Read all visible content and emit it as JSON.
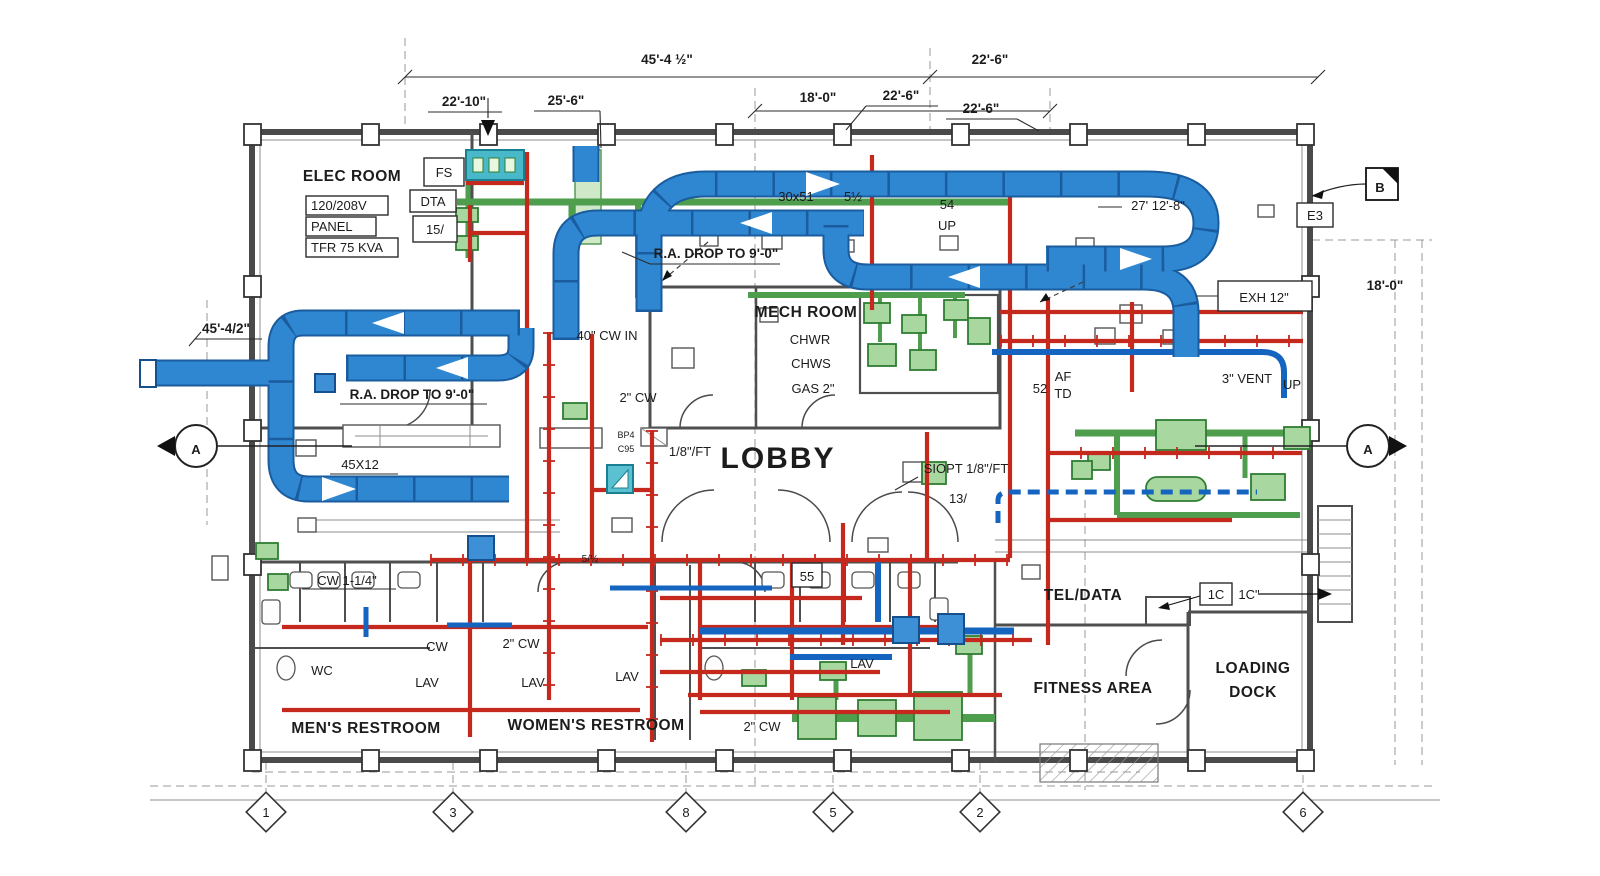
{
  "meta": {
    "drawing_type": "MEP floor plan blueprint"
  },
  "colors": {
    "duct_blue": "#2f87d2",
    "pipe_red": "#c5281c",
    "equip_green": "#a8d8a0",
    "teal_unit": "#4ab5c4",
    "wall_gray": "#4a4a4a"
  },
  "t": {
    "dim_45_4": "45'-4 ½\"",
    "dim_22_6a": "22'-6\"",
    "dim_18_0": "18'-0\"",
    "dim_22_10": "22'-10\"",
    "dim_25_6": "25'-6\"",
    "dim_22_6b": "22'-6\"",
    "dim_22_6c": "22'-6\"",
    "dim_18_0_right": "18'-0\"",
    "dim_45_4_left": "45'-4/2\"",
    "dim_27_12": "27' 12'-8\"",
    "elec_room": "ELEC ROOM",
    "panel_volts": "120/208V",
    "panel": "PANEL",
    "tfr": "TFR 75 KVA",
    "fs": "FS",
    "dta": "DTA",
    "fifteen": "15/",
    "duct_size": "30x51",
    "five_half": "5½",
    "fifty_four": "54",
    "up1": "UP",
    "ra_drop_top": "R.A. DROP TO 9'-0\"",
    "ra_drop_left": "R.A. DROP TO 9'-0\"",
    "e3": "E3",
    "exh": "EXH 12\"",
    "mech_room": "MECH ROOM",
    "chwr": "CHWR",
    "chws": "CHWS",
    "gas2": "GAS 2\"",
    "cw_in": "40\" CW IN",
    "cw2_a": "2\" CW",
    "slope1": "1/8\"/FT",
    "bp4": "BP4",
    "c95": "C95",
    "lobby": "LOBBY",
    "slope2": "SIOPT 1/8\"/FT",
    "thirteen": "13/",
    "af": "AF",
    "td": "TD",
    "fifty_two": "52",
    "vent3": "3\" VENT",
    "up2": "UP",
    "duct_45x12": "45X12",
    "cw114": "CW 1-1/4\"",
    "cw": "CW",
    "cw2_b": "2\" CW",
    "cw2_c": "2\" CW",
    "s_half": "5/½",
    "wc": "WC",
    "lav1": "LAV",
    "lav2": "LAV",
    "lav3": "LAV",
    "lav4": "LAV",
    "mens": "MEN'S RESTROOM",
    "womens": "WOMEN'S RESTROOM",
    "fifty_five": "55",
    "tel_data": "TEL/DATA",
    "c1_box": "1C",
    "c1_dim": "1C\"",
    "fitness": "FITNESS AREA",
    "loading": "LOADING",
    "dock": "DOCK",
    "sec_a_left": "A",
    "sec_a_right": "A",
    "sec_b": "B"
  },
  "grid_bubbles": [
    "1",
    "3",
    "8",
    "5",
    "2",
    "6"
  ]
}
